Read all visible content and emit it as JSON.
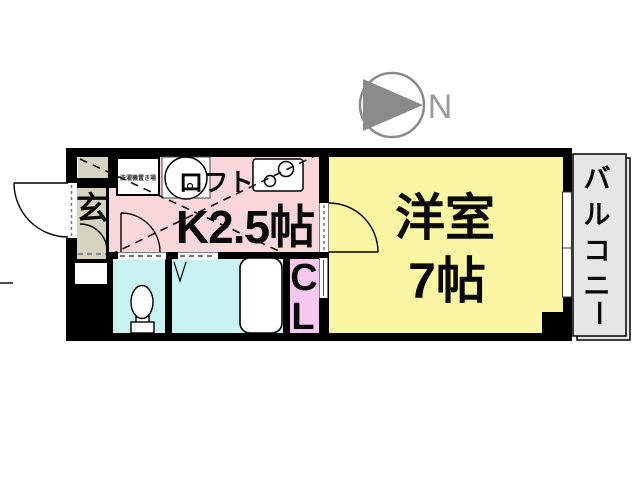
{
  "page": {
    "type": "apartment-floor-plan",
    "background": "#ffffff"
  },
  "compass": {
    "label": "N",
    "direction": "north-right"
  },
  "rooms": {
    "entrance": {
      "label": "玄"
    },
    "kitchen": {
      "label": "K2.5帖",
      "loft_label": "ロフト",
      "washer_label": "洗濯機置き場"
    },
    "western": {
      "name": "洋室",
      "size": "7帖"
    },
    "closet": {
      "label": "CL",
      "char1": "C",
      "char2": "L"
    },
    "balcony": {
      "label": "バルコニー",
      "chars": [
        "バ",
        "ル",
        "コ",
        "ニ",
        "ー"
      ]
    },
    "toilet": {
      "fixture": "toilet"
    },
    "bath": {
      "fixture": "bathtub"
    }
  },
  "colors": {
    "wall": "#000000",
    "kitchen": "#f9d7da",
    "entrance": "#d7d3c1",
    "wet_area": "#c9f2f2",
    "closet": "#f6c8f0",
    "western_room": "#faf6a4",
    "balcony": "#e6e6e6",
    "compass_gray": "#8a8a8a"
  }
}
